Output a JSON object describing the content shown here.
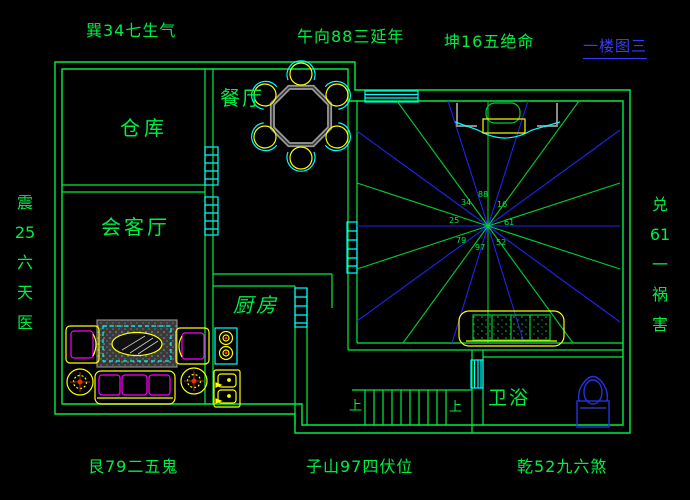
{
  "title": {
    "sheet_label": "一楼图三"
  },
  "perimeter_labels": {
    "top_left": "巽34七生气",
    "top_center": "午向88三延年",
    "top_right": "坤16五绝命",
    "bottom_left": "艮79二五鬼",
    "bottom_center": "子山97四伏位",
    "bottom_right": "乾52九六煞",
    "left": {
      "full": "震25六天医",
      "lines": [
        "震",
        "25",
        "六",
        "天",
        "医"
      ]
    },
    "right": {
      "full": "兑61一祸害",
      "lines": [
        "兑",
        "61",
        "一",
        "祸",
        "害"
      ]
    }
  },
  "rooms": {
    "storage": {
      "label": "仓库"
    },
    "dining": {
      "label": "餐厅"
    },
    "living": {
      "label": "会客厅"
    },
    "kitchen": {
      "label": "厨房"
    },
    "bath": {
      "label": "卫浴"
    }
  },
  "stairs": {
    "up_label_left": "上",
    "up_label_right": "上"
  },
  "compass_numbers": {
    "nw": "34",
    "n": "88",
    "ne": "16",
    "w": "25",
    "e": "61",
    "sw": "79",
    "s": "97",
    "se": "52"
  },
  "colors": {
    "wall_green": "#00ee44",
    "window_cyan": "#00ffff",
    "furniture_yellow": "#ffff00",
    "accent_magenta": "#ff00ff",
    "ray_blue": "#2222ee",
    "ray_green": "#00cc33",
    "title_blue": "#3a3aff",
    "table_gray": "#999999",
    "toilet_blue": "#2233dd",
    "background": "#000000"
  }
}
